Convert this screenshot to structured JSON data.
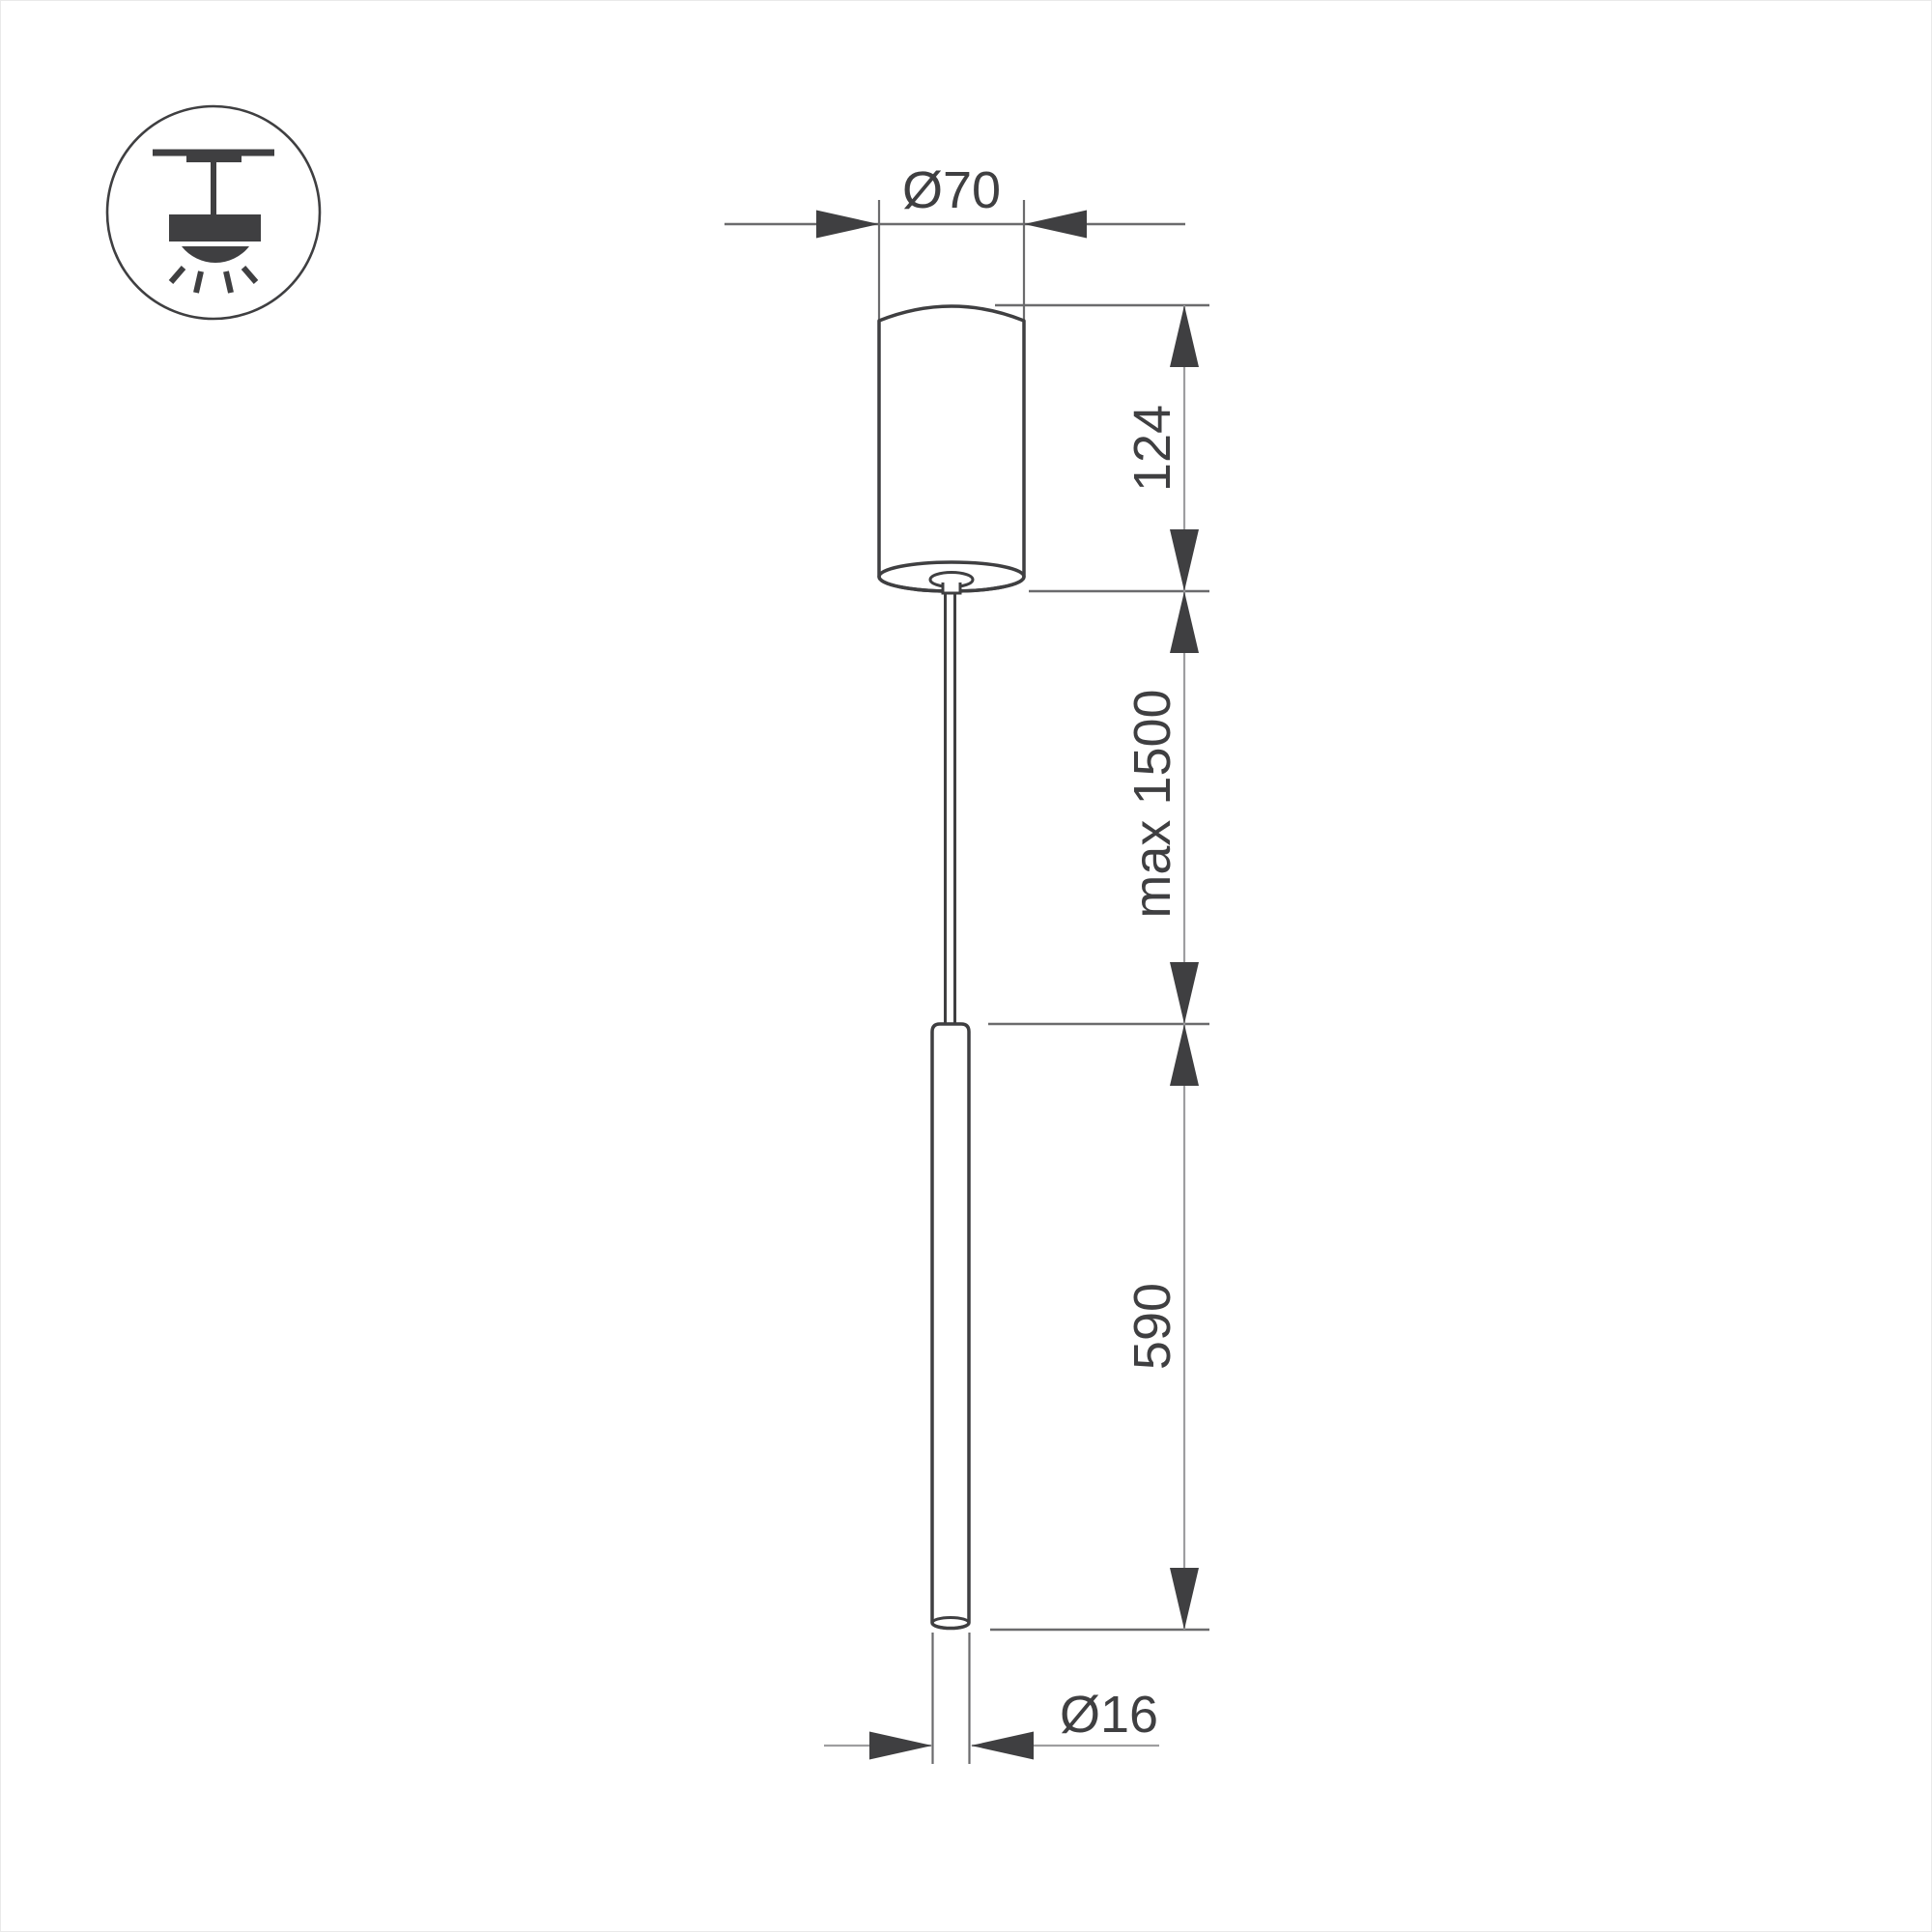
{
  "drawing": {
    "title": "pendant-light-dimension-drawing",
    "icon": {
      "type": "ceiling-mount-pendant"
    },
    "dimensions": {
      "canopy_diameter": {
        "label": "Ø70",
        "value": 70
      },
      "canopy_height": {
        "label": "124",
        "value": 124
      },
      "suspension_length": {
        "label": "max 1500",
        "value": 1500
      },
      "tube_length": {
        "label": "590",
        "value": 590
      },
      "tube_diameter": {
        "label": "Ø16",
        "value": 16
      }
    },
    "colors": {
      "background": "#ffffff",
      "outline": "#3f3f41",
      "dim_line": "#6b6b6d",
      "light_line": "#9e9ea0",
      "text": "#3f3f41"
    }
  }
}
